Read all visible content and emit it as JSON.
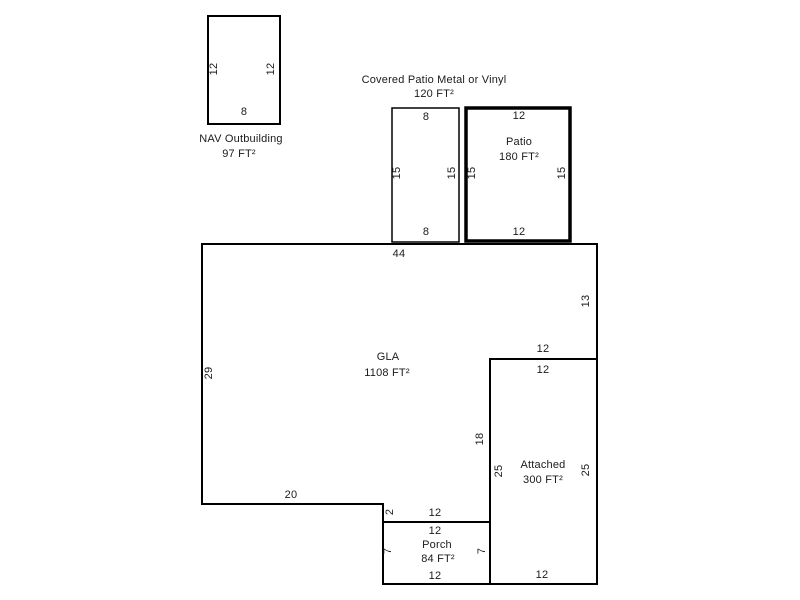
{
  "colors": {
    "line": "#000000",
    "text": "#1b1b1b",
    "background": "#ffffff"
  },
  "areas": {
    "outbuilding": {
      "label": "NAV Outbuilding",
      "area": "97 FT²",
      "dim_left": "12",
      "dim_right": "12",
      "dim_bottom": "8"
    },
    "covered_patio": {
      "label": "Covered Patio Metal or Vinyl",
      "area": "120 FT²",
      "dim_top": "8",
      "dim_bottom": "8",
      "dim_left": "15",
      "dim_right": "15"
    },
    "patio": {
      "label": "Patio",
      "area": "180 FT²",
      "dim_top": "12",
      "dim_bottom": "12",
      "dim_left": "15",
      "dim_right": "15"
    },
    "gla": {
      "label": "GLA",
      "area": "1108 FT²",
      "dim_top": "44",
      "dim_left": "29",
      "dim_right": "13",
      "dim_notch": "12",
      "dim_inner_right": "18",
      "dim_step": "2",
      "dim_bottom_left": "20",
      "dim_bottom_mid": "12"
    },
    "attached": {
      "label": "Attached",
      "area": "300 FT²",
      "dim_top": "12",
      "dim_bottom": "12",
      "dim_left": "25",
      "dim_right": "25"
    },
    "porch": {
      "label": "Porch",
      "area": "84 FT²",
      "dim_top": "12",
      "dim_bottom": "12",
      "dim_left": "7",
      "dim_right": "7"
    }
  }
}
